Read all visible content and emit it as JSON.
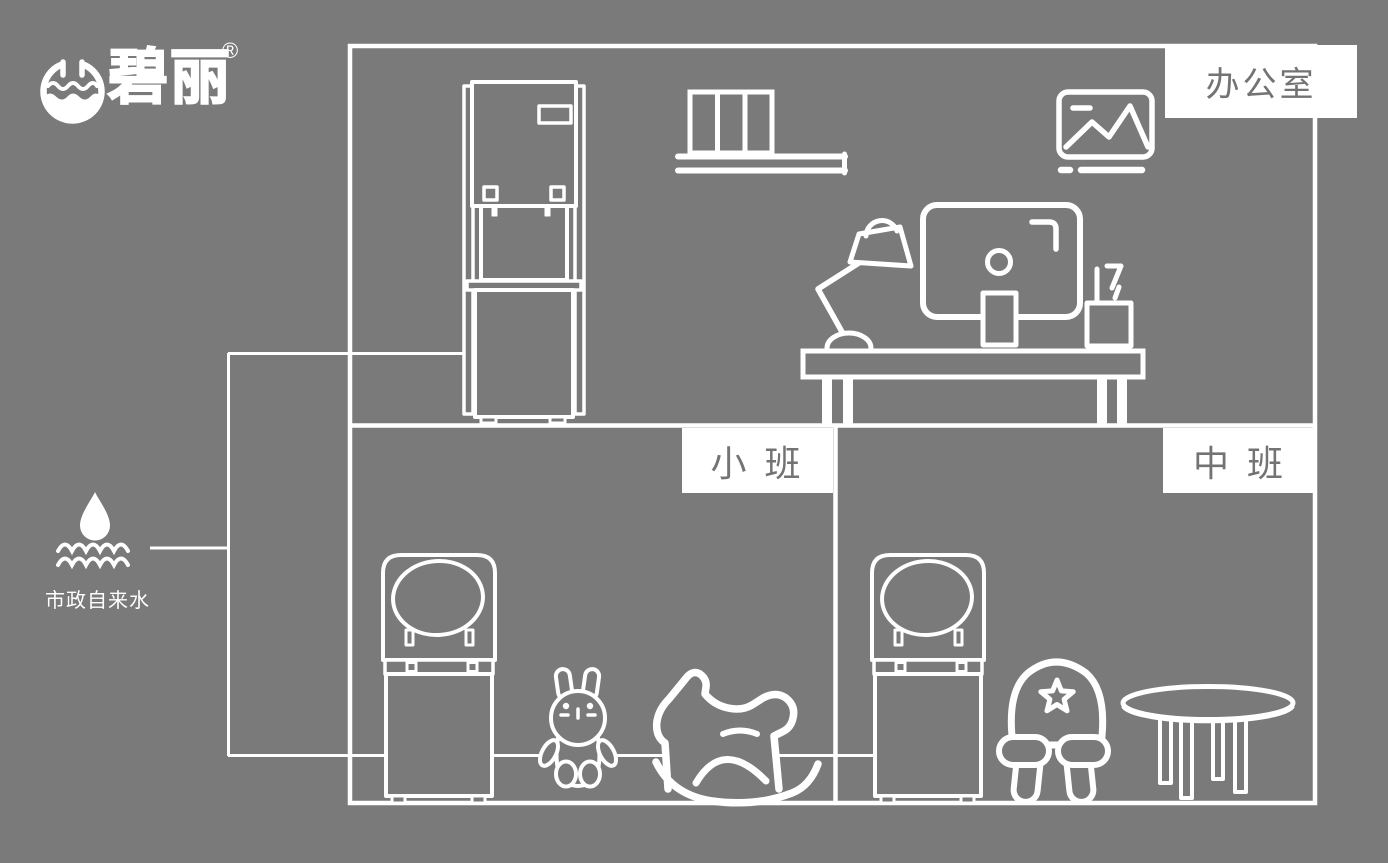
{
  "colors": {
    "background": "#7a7a7a",
    "line": "#ffffff",
    "label_box_background": "#ffffff",
    "label_text": "#737373"
  },
  "brand": {
    "name": "碧丽",
    "registered_mark": "®",
    "logo_icon": "water-bowl-logo-icon"
  },
  "water_source": {
    "label": "市政自来水",
    "icon": "water-drop-waves-icon"
  },
  "rooms": [
    {
      "id": "office",
      "label": "办公室",
      "equipment_icons": [
        "floor-standing-water-dispenser-icon",
        "bookshelf-icon",
        "picture-frame-icon",
        "desk-icon",
        "desk-lamp-icon",
        "monitor-icon",
        "pen-holder-icon"
      ]
    },
    {
      "id": "junior-class",
      "label": "小 班",
      "equipment_icons": [
        "kindergarten-water-dispenser-icon",
        "bunny-toy-icon",
        "rocking-horse-icon"
      ]
    },
    {
      "id": "middle-class",
      "label": "中 班",
      "equipment_icons": [
        "kindergarten-water-dispenser-icon",
        "kids-chair-icon",
        "round-table-icon"
      ]
    }
  ]
}
